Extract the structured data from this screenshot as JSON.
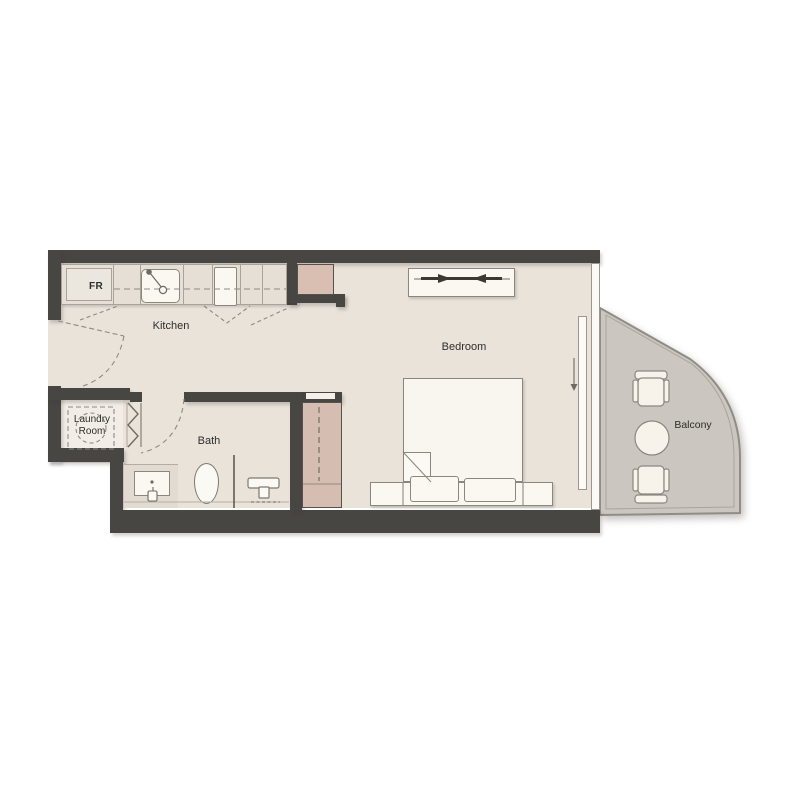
{
  "labels": {
    "kitchen": "Kitchen",
    "bedroom": "Bedroom",
    "bath": "Bath",
    "laundry_line1": "Laundry",
    "laundry_line2": "Room",
    "balcony": "Balcony",
    "fridge": "FR"
  },
  "colors": {
    "wall": "#484643",
    "floor": "#e9e3da",
    "laundry_floor": "#f2eee7",
    "counter": "#e6dfd6",
    "accent_pink": "#d8bfb2",
    "balcony_floor": "#cbc7c0",
    "fixture_white": "#faf8f1",
    "line_gray": "#8b877f",
    "text": "#2e2d2a"
  },
  "fixtures": {
    "kitchen": [
      "fridge",
      "sink",
      "stove"
    ],
    "bath": [
      "vanity-sink",
      "toilet",
      "glass-partition",
      "shower"
    ],
    "laundry": [
      "washing-machine",
      "bifold-door"
    ],
    "bedroom": [
      "tv-console",
      "bed",
      "pillows",
      "nightstands",
      "wardrobe",
      "sliding-door"
    ],
    "balcony": [
      "chair",
      "round-table",
      "chair"
    ]
  }
}
